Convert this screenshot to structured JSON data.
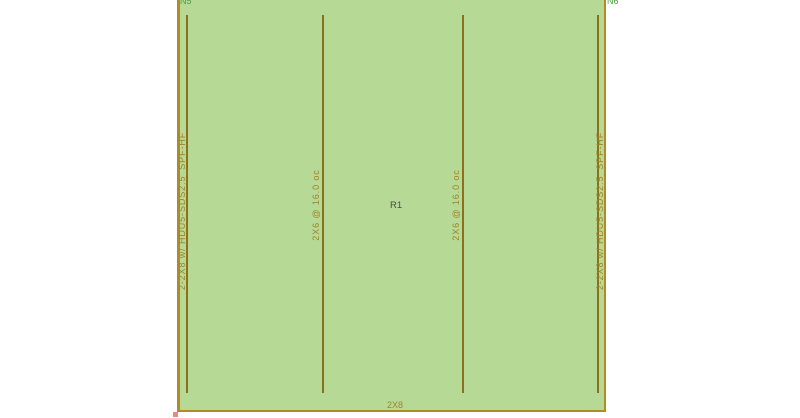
{
  "drawing": {
    "node_label_left": "N5",
    "node_label_right": "N6",
    "panel_label": "R1",
    "bottom_plate_label": "2X8",
    "stud_labels": [
      "2X6 @ 16.0 oc",
      "2X6 @ 16.0 oc"
    ],
    "left_post_label": "2-2X8 w/ HDU5-SDS2.5_SPF-HF",
    "right_post_label": "2-2X8 w/ HDU5-SDS2.5_SPF-HF",
    "colors": {
      "panel_fill": "#b6da96",
      "frame_line": "#b08c28",
      "stud_line": "#8d701c",
      "annotation_olive": "#a08326",
      "node_green": "#4f9d44",
      "panel_text": "#4a4a4a",
      "node_marker_red": "#f08878"
    }
  }
}
